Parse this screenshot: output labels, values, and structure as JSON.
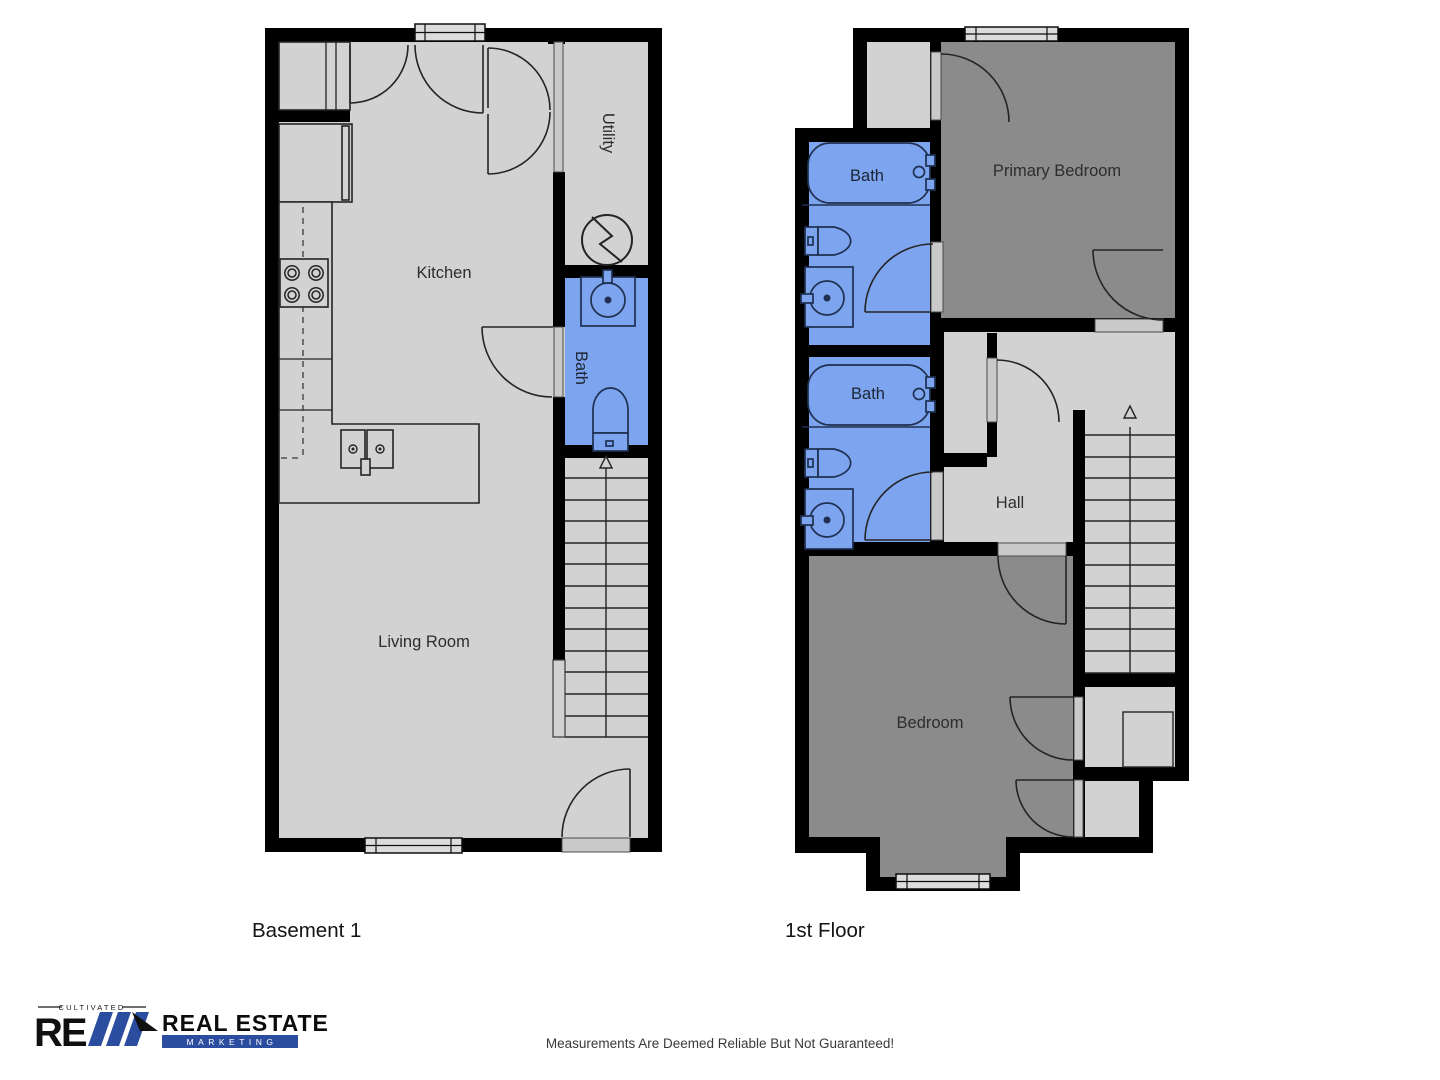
{
  "colors": {
    "wall": "#000000",
    "floor_light": "#d2d2d2",
    "floor_dark": "#8b8b8b",
    "bath_blue": "#7da4ef",
    "door_gray": "#c9c9c9",
    "window_gray": "#dcdcdc",
    "fixture_navy": "#1f3050",
    "logo_blue": "#2b4da0"
  },
  "basement": {
    "title": "Basement 1",
    "rooms": {
      "kitchen": "Kitchen",
      "living_room": "Living Room",
      "bath": "Bath",
      "utility": "Utility"
    }
  },
  "first_floor": {
    "title": "1st Floor",
    "rooms": {
      "primary_bedroom": "Primary Bedroom",
      "bath_upper": "Bath",
      "bath_lower": "Bath",
      "hall": "Hall",
      "bedroom": "Bedroom"
    }
  },
  "footer": {
    "disclaimer": "Measurements Are Deemed Reliable But Not Guaranteed!"
  },
  "logo": {
    "tagline": "CULTIVATED",
    "name_line1": "REAL ESTATE",
    "name_line2": "MARKETING"
  }
}
